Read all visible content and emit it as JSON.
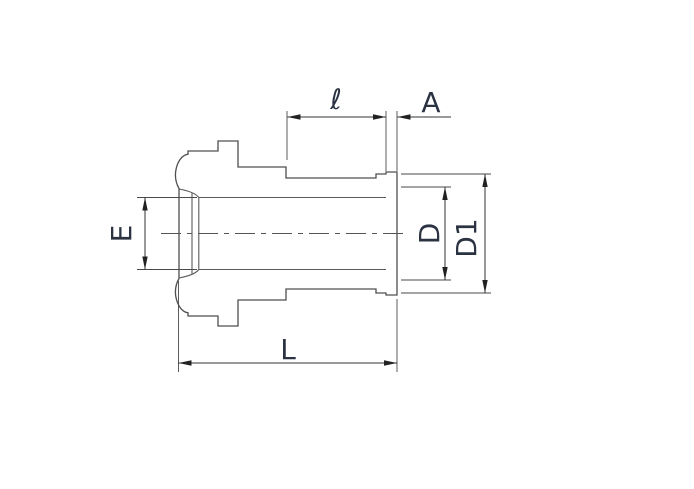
{
  "diagram": {
    "type": "technical-drawing",
    "subject": "tube-fitting-gland-cross-section-side-view",
    "labels": {
      "stub_length": "ℓ",
      "collar_width": "A",
      "bore_diameter": "E",
      "face_bore_diameter": "D",
      "collar_diameter": "D1",
      "overall_length": "L"
    },
    "colors": {
      "background": "#ffffff",
      "outline": "#4f4f4f",
      "dimension_lines": "#333333",
      "arrowheads": "#222222",
      "label_text": "#2b3342"
    }
  }
}
